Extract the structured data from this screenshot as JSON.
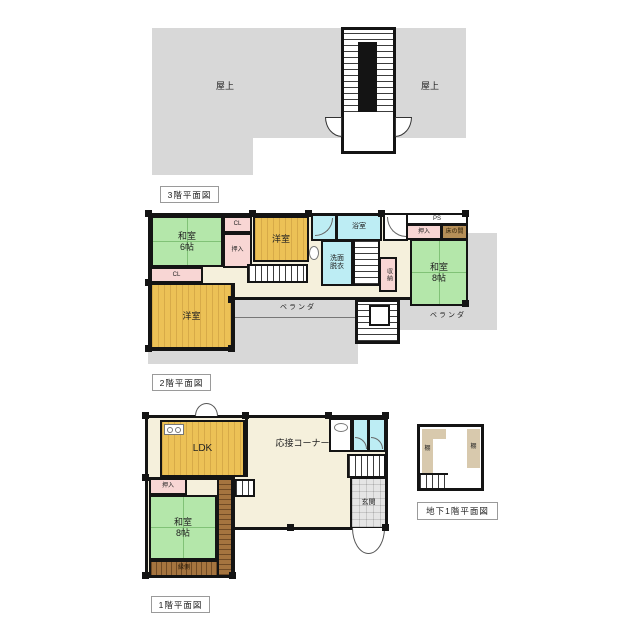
{
  "colors": {
    "wall": "#141414",
    "tatami": "#b4e7aa",
    "wood": "#ecc156",
    "water": "#bdedf4",
    "closet": "#f8d6d4",
    "tokonoma": "#b68f58",
    "deck": "#a5743f",
    "hall": "#f5f0dc",
    "roof": "#d8d8d8",
    "tile": "#e5e5e5",
    "shelf": "#d8c9ad"
  },
  "floor3": {
    "title": "3階平面図",
    "rooftop_left": "屋上",
    "rooftop_right": "屋上"
  },
  "floor2": {
    "title": "2階平面図",
    "washitsu6_line1": "和室",
    "washitsu6_line2": "6帖",
    "cl_top": "CL",
    "oshiire_left": "押入",
    "youshitsu_top": "洋室",
    "bathroom": "浴室",
    "senmen_line1": "洗面",
    "senmen_line2": "脱衣",
    "ps": "PS",
    "oshiire_right": "押入",
    "tokonoma": "床の間",
    "washitsu8_line1": "和室",
    "washitsu8_line2": "8帖",
    "shunou": "収納",
    "cl_left": "CL",
    "youshitsu_bottom": "洋室",
    "veranda_bottom": "ベランダ",
    "veranda_right": "ベランダ"
  },
  "floor1": {
    "title": "1階平面図",
    "ldk": "LDK",
    "reception": "応接コーナー",
    "oshiire": "押入",
    "washitsu8_line1": "和室",
    "washitsu8_line2": "8帖",
    "engawa": "縁側",
    "genkan": "玄関"
  },
  "basement": {
    "title": "地下1階平面図",
    "shelf_left": "棚",
    "shelf_right": "棚"
  }
}
